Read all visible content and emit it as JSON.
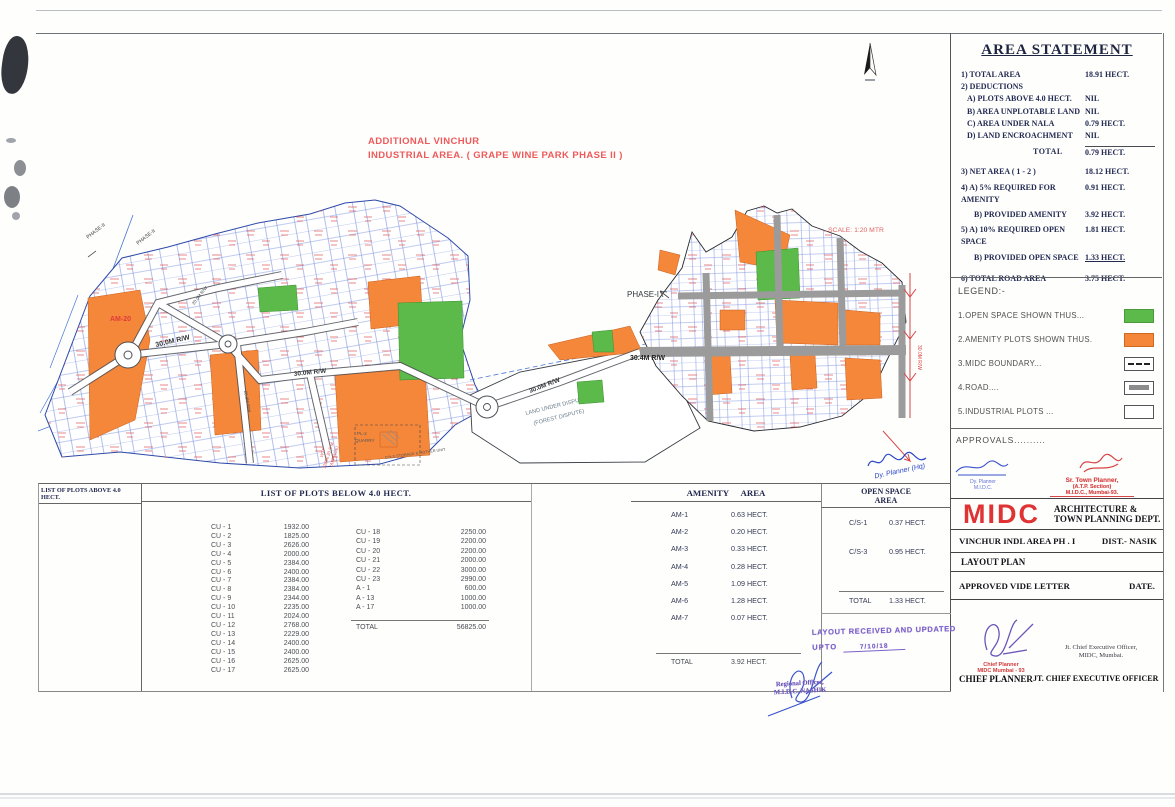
{
  "map": {
    "title_line1": "ADDITIONAL  VINCHUR",
    "title_line2": "INDUSTRIAL AREA. ( GRAPE WINE PARK PHASE II )",
    "scale": "SCALE: 1:20 MTR",
    "phase1": "PHASE-I",
    "phase2": "PHASE-II",
    "phase_line": "PHASE LINE",
    "road_30_0": "30.0M R/W",
    "road_30_4": "30.4M R/W",
    "road_20_0": "20.0M R/W",
    "am20": "AM-20",
    "wtp1": "WTP",
    "wtp2": "12896.20 S.M",
    "wtp3": "(APPROX)",
    "quarry1": "PL-2",
    "quarry2": "QUARRY",
    "cold_storage": "COLD STORAGE & MOTHER UNIT",
    "dispute1": "LAND UNDER DISPUTE",
    "dispute2": "(FOREST DISPUTE)"
  },
  "area_statement": {
    "title": "AREA STATEMENT",
    "rows": [
      {
        "label": "1) TOTAL AREA",
        "value": "18.91 HECT."
      },
      {
        "label": "2) DEDUCTIONS",
        "value": ""
      },
      {
        "label": "A) PLOTS ABOVE 4.0 HECT.",
        "value": "NIL"
      },
      {
        "label": "B) AREA UNPLOTABLE  LAND",
        "value": "NIL"
      },
      {
        "label": "C) AREA UNDER NALA",
        "value": "0.79 HECT."
      },
      {
        "label": "D) LAND ENCROACHMENT",
        "value": "NIL"
      },
      {
        "label": "TOTAL",
        "value": "0.79 HECT."
      },
      {
        "label": "3) NET AREA ( 1 - 2 )",
        "value": "18.12 HECT."
      },
      {
        "label": "4) A) 5% REQUIRED FOR AMENITY",
        "value": "0.91 HECT."
      },
      {
        "label": "B) PROVIDED AMENITY",
        "value": "3.92 HECT."
      },
      {
        "label": "5) A) 10% REQUIRED OPEN SPACE",
        "value": "1.81 HECT."
      },
      {
        "label": "B) PROVIDED OPEN SPACE",
        "value": "1.33 HECT."
      },
      {
        "label": "6) TOTAL ROAD AREA",
        "value": "3.75 HECT."
      }
    ]
  },
  "legend": {
    "title": "LEGEND:-",
    "items": [
      {
        "label": "1.OPEN SPACE SHOWN THUS...",
        "swatch": "green",
        "color": "#5cba4a"
      },
      {
        "label": "2.AMENITY PLOTS SHOWN THUS.",
        "swatch": "orange",
        "color": "#f5873b"
      },
      {
        "label": "3.MIDC BOUNDARY...",
        "swatch": "dashed"
      },
      {
        "label": "4.ROAD....",
        "swatch": "road"
      },
      {
        "label": "5.INDUSTRIAL PLOTS ...",
        "swatch": "white"
      }
    ]
  },
  "approvals": {
    "title": "APPROVALS..........",
    "dy_planner_hw": "Dy. Planner (Hq)",
    "dy_planner_stamp1": "Dy. Planner",
    "dy_planner_stamp2": "M.I.D.C.",
    "sr_town1": "Sr. Town Planner,",
    "sr_town2": "(A.T.P. Section)",
    "sr_town3": "M.I.D.C., Mumbai-93."
  },
  "title_block": {
    "logo": "MIDC",
    "dept1": "ARCHITECTURE &",
    "dept2": "TOWN PLANNING DEPT.",
    "area_name": "VINCHUR INDL AREA  PH . I",
    "district": "DIST.- NASIK",
    "drawing": "LAYOUT PLAN",
    "approved": "APPROVED VIDE LETTER",
    "date_label": "DATE.",
    "cp_stamp1": "Chief Planner",
    "cp_stamp2": "MIDC Mumbai - 93",
    "cp_title": "CHIEF PLANNER",
    "jt_line1": "Jt. Chief Executive Officer,",
    "jt_line2": "MIDC, Mumbai.",
    "jt_title": "JT. CHIEF EXECUTIVE OFFICER"
  },
  "plots_above": {
    "title": "LIST OF PLOTS ABOVE 4.0 HECT."
  },
  "plots_below": {
    "title": "LIST OF PLOTS BELOW 4.0 HECT.",
    "left": [
      {
        "id": "CU - 1",
        "area": "1932.00"
      },
      {
        "id": "CU - 2",
        "area": "1825.00"
      },
      {
        "id": "CU - 3",
        "area": "2626.00"
      },
      {
        "id": "CU - 4",
        "area": "2000.00"
      },
      {
        "id": "CU - 5",
        "area": "2384.00"
      },
      {
        "id": "CU - 6",
        "area": "2400.00"
      },
      {
        "id": "CU - 7",
        "area": "2384.00"
      },
      {
        "id": "CU - 8",
        "area": "2384.00"
      },
      {
        "id": "CU - 9",
        "area": "2344.00"
      },
      {
        "id": "CU - 10",
        "area": "2235.00"
      },
      {
        "id": "CU - 11",
        "area": "2024.00"
      },
      {
        "id": "CU - 12",
        "area": "2768.00"
      },
      {
        "id": "CU - 13",
        "area": "2229.00"
      },
      {
        "id": "CU - 14",
        "area": "2400.00"
      },
      {
        "id": "CU - 15",
        "area": "2400.00"
      },
      {
        "id": "CU - 16",
        "area": "2625.00"
      },
      {
        "id": "CU - 17",
        "area": "2625.00"
      }
    ],
    "right": [
      {
        "id": "CU - 18",
        "area": "2250.00"
      },
      {
        "id": "CU - 19",
        "area": "2200.00"
      },
      {
        "id": "CU - 20",
        "area": "2200.00"
      },
      {
        "id": "CU - 21",
        "area": "2000.00"
      },
      {
        "id": "CU - 22",
        "area": "3000.00"
      },
      {
        "id": "CU - 23",
        "area": "2990.00"
      },
      {
        "id": "A - 1",
        "area": "600.00"
      },
      {
        "id": "A - 13",
        "area": "1000.00"
      },
      {
        "id": "A - 17",
        "area": "1000.00"
      }
    ],
    "total_label": "TOTAL",
    "total_value": "56825.00"
  },
  "amenity": {
    "title": "AMENITY AREA",
    "rows": [
      {
        "id": "AM-1",
        "area": "0.63 HECT."
      },
      {
        "id": "AM-2",
        "area": "0.20 HECT."
      },
      {
        "id": "AM-3",
        "area": "0.33 HECT."
      },
      {
        "id": "AM-4",
        "area": "0.28 HECT."
      },
      {
        "id": "AM-5",
        "area": "1.09 HECT."
      },
      {
        "id": "AM-6",
        "area": "1.28 HECT."
      },
      {
        "id": "AM-7",
        "area": "0.07 HECT."
      }
    ],
    "total_label": "TOTAL",
    "total_value": "3.92 HECT."
  },
  "open_space": {
    "title1": "OPEN SPACE",
    "title2": "AREA",
    "rows": [
      {
        "id": "C/S-1",
        "area": "0.37 HECT."
      },
      {
        "id": "C/S-3",
        "area": "0.95 HECT."
      }
    ],
    "total_label": "TOTAL",
    "total_value": "1.33 HECT."
  },
  "stamps": {
    "layout_l1": "LAYOUT RECEIVED AND UPDATED",
    "layout_l2": "UPTO",
    "layout_date": "7/10/18",
    "regional_l1": "Regional Officer,",
    "regional_l2": "M.I.D.C. NASHIK"
  },
  "colors": {
    "open_space": "#5cba4a",
    "amenity": "#f5873b",
    "road_gray": "#9b9b9b",
    "plot_line_blue": "#5f79d6",
    "red_label": "#e25555",
    "navy_text": "#232a52",
    "stamp_purple": "#7d63c9",
    "ink_blue": "#2b46c8",
    "midc_red": "#e03434"
  }
}
